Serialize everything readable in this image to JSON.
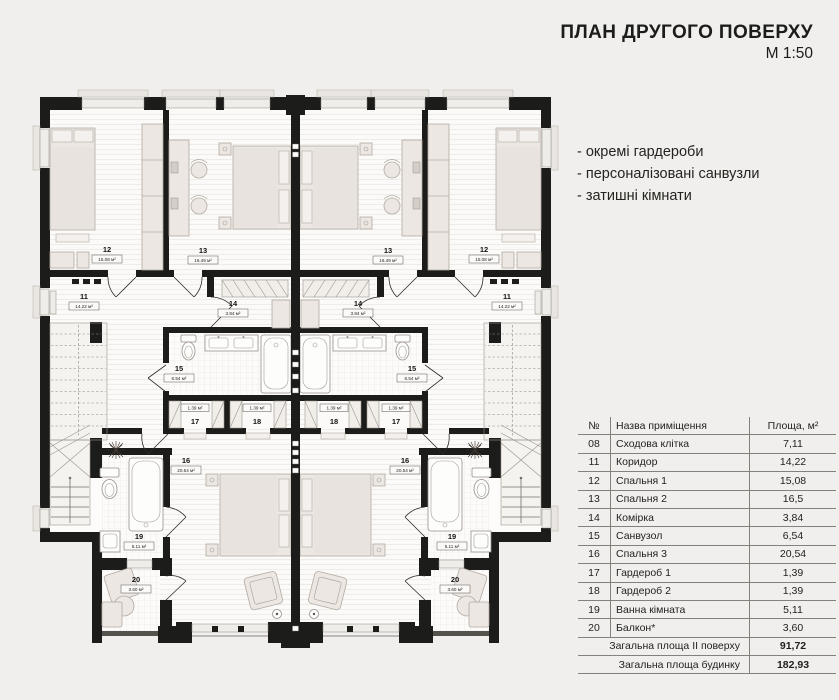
{
  "header": {
    "title": "ПЛАН ДРУГОГО ПОВЕРХУ",
    "scale": "М 1:50"
  },
  "features": [
    "- окремі гардероби",
    "- персоналізовані санвузли",
    "- затишні кімнати"
  ],
  "plan": {
    "rooms": {
      "r11": {
        "num": "11",
        "area": "14.22 м²"
      },
      "r12": {
        "num": "12",
        "area": "15.08 м²"
      },
      "r13": {
        "num": "13",
        "area": "16.49 м²"
      },
      "r14": {
        "num": "14",
        "area": "3.84 м²"
      },
      "r15": {
        "num": "15",
        "area": "6.54 м²"
      },
      "r16": {
        "num": "16",
        "area": "20.54 м²"
      },
      "r17": {
        "num": "17",
        "area": "1.39 м²"
      },
      "r18": {
        "num": "18",
        "area": "1.39 м²"
      },
      "r19": {
        "num": "19",
        "area": "5.11 м²"
      },
      "r20": {
        "num": "20",
        "area": "3.60 м²"
      }
    }
  },
  "table": {
    "headers": {
      "num": "№",
      "name": "Назва приміщення",
      "area": "Площа, м²"
    },
    "rows": [
      {
        "num": "08",
        "name": "Сходова клітка",
        "area": "7,11"
      },
      {
        "num": "11",
        "name": "Коридор",
        "area": "14,22"
      },
      {
        "num": "12",
        "name": "Спальня 1",
        "area": "15,08"
      },
      {
        "num": "13",
        "name": "Спальня 2",
        "area": "16,5"
      },
      {
        "num": "14",
        "name": "Комірка",
        "area": "3,84"
      },
      {
        "num": "15",
        "name": "Санвузол",
        "area": "6,54"
      },
      {
        "num": "16",
        "name": "Спальня 3",
        "area": "20,54"
      },
      {
        "num": "17",
        "name": "Гардероб 1",
        "area": "1,39"
      },
      {
        "num": "18",
        "name": "Гардероб 2",
        "area": "1,39"
      },
      {
        "num": "19",
        "name": "Ванна кімната",
        "area": "5,11"
      },
      {
        "num": "20",
        "name": "Балкон*",
        "area": "3,60"
      }
    ],
    "summary": [
      {
        "label": "Загальна площа ІІ поверху",
        "value": "91,72"
      },
      {
        "label": "Загальна площа будинку",
        "value": "182,93"
      }
    ]
  },
  "colors": {
    "background": "#f0efed",
    "wall": "#1c1c1a",
    "furniture": "#ece7e2"
  }
}
